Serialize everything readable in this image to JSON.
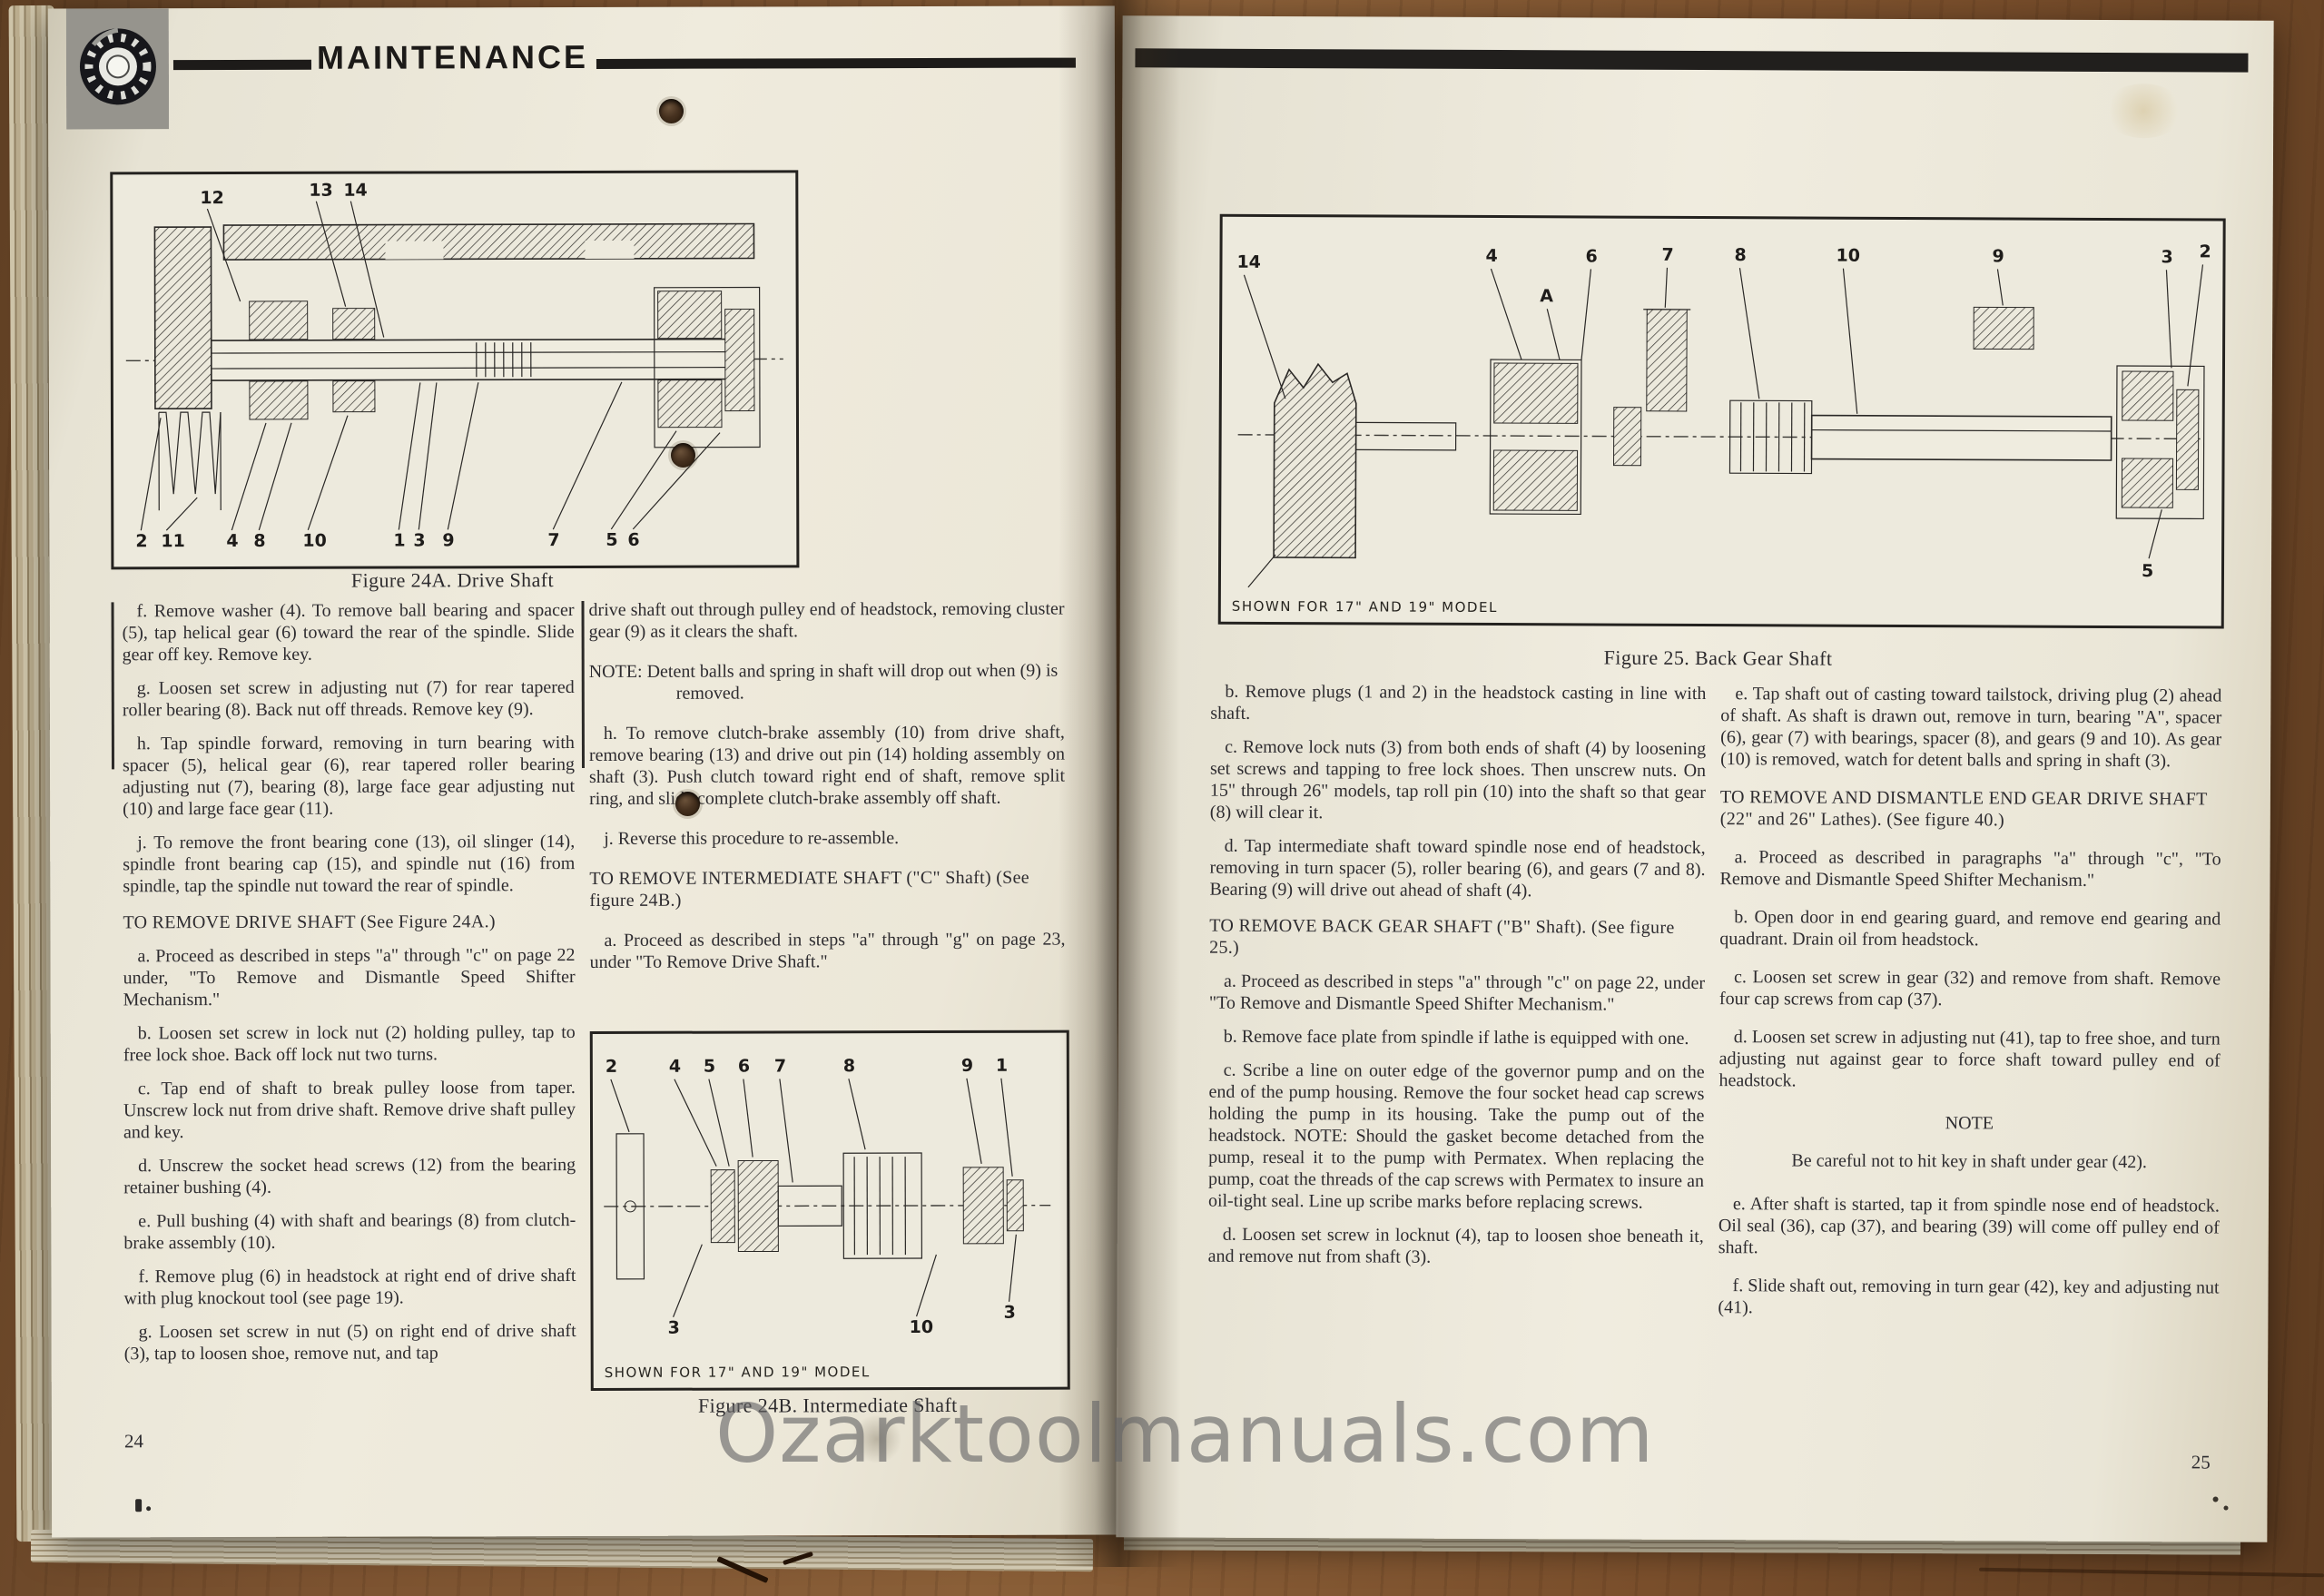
{
  "watermark": "Ozarktoolmanuals.com",
  "header": {
    "title": "MAINTENANCE"
  },
  "left_page": {
    "page_number": "24",
    "fig24a": {
      "caption": "Figure 24A.  Drive Shaft",
      "labels_top": [
        "12",
        "13",
        "14"
      ],
      "labels_bottom": [
        "2",
        "11",
        "4",
        "8",
        "10",
        "1",
        "3",
        "9",
        "7",
        "5",
        "6"
      ]
    },
    "fig24b": {
      "caption": "Figure 24B.  Intermediate Shaft",
      "note": "SHOWN FOR 17\" AND 19\" MODEL",
      "labels_top": [
        "2",
        "4",
        "5",
        "6",
        "7",
        "8",
        "9",
        "1"
      ],
      "labels_bottom": [
        "3",
        "10",
        "3"
      ]
    },
    "col1": [
      {
        "text": "f.  Remove washer (4).  To remove ball bearing and spacer (5), tap helical gear (6) toward the rear of the spindle.  Slide gear off key.  Remove key."
      },
      {
        "text": "g.  Loosen set screw in adjusting nut (7) for rear tapered roller bearing (8).  Back nut off threads.  Remove key (9)."
      },
      {
        "text": "h.  Tap spindle forward, removing in turn bearing with spacer (5), helical gear (6), rear tapered roller bearing adjusting nut (7), bearing (8), large face gear adjusting nut (10) and large face gear (11)."
      },
      {
        "text": "j.  To remove the front bearing cone (13), oil slinger (14), spindle front bearing cap (15), and spindle nut (16) from spindle, tap the spindle nut toward the rear of spindle."
      },
      {
        "text": "TO REMOVE DRIVE SHAFT (See Figure 24A.)"
      },
      {
        "text": "a.  Proceed as described in steps \"a\" through \"c\" on page 22 under, \"To Remove and Dismantle Speed Shifter Mechanism.\""
      },
      {
        "text": "b.  Loosen set screw in lock nut (2) holding pulley, tap to free lock shoe.  Back off lock nut two turns."
      },
      {
        "text": "c.  Tap end of shaft to break pulley loose from taper. Unscrew lock nut from drive shaft.  Remove drive shaft pulley and key."
      },
      {
        "text": "d.  Unscrew the socket head screws (12) from the bearing retainer bushing (4)."
      },
      {
        "text": "e.  Pull bushing (4) with shaft and bearings (8) from clutch-brake assembly (10)."
      },
      {
        "text": "f.  Remove plug (6) in headstock at right end of drive shaft with plug knockout tool (see page 19)."
      },
      {
        "text": "g.  Loosen set screw in nut (5) on right end of drive shaft (3), tap to loosen shoe, remove nut, and tap"
      }
    ],
    "col2": [
      {
        "text": "drive shaft out through pulley end of headstock, removing cluster gear (9) as it clears the shaft."
      },
      {
        "text": "NOTE:   Detent balls and spring in shaft will drop out when (9) is removed."
      },
      {
        "text": "h.  To remove clutch-brake assembly (10) from drive shaft, remove bearing (13) and drive out pin (14) holding assembly on shaft (3).  Push clutch toward right end of shaft, remove split ring, and slide complete clutch-brake assembly off shaft."
      },
      {
        "text": "j.  Reverse this procedure to re-assemble."
      },
      {
        "text": "TO REMOVE INTERMEDIATE SHAFT (\"C\" Shaft) (See figure 24B.)"
      },
      {
        "text": "a.  Proceed as described in steps \"a\" through \"g\" on page 23, under \"To Remove Drive Shaft.\""
      }
    ]
  },
  "right_page": {
    "page_number": "25",
    "fig25": {
      "caption": "Figure 25.  Back Gear Shaft",
      "note": "SHOWN FOR 17\" AND 19\" MODEL",
      "labels_top": [
        "14",
        "4",
        "A",
        "6",
        "7",
        "8",
        "10",
        "9",
        "3",
        "2"
      ],
      "labels_bottom": [
        "5"
      ]
    },
    "col1": [
      {
        "text": "b.  Remove plugs (1 and 2) in the headstock casting in line with shaft."
      },
      {
        "text": "c.  Remove lock nuts (3) from both ends of shaft (4) by loosening set screws and tapping to free lock shoes.  Then unscrew nuts.  On 15\" through 26\" models, tap roll pin (10) into the shaft so that gear (8) will clear it."
      },
      {
        "text": "d.  Tap intermediate shaft toward spindle nose end of headstock, removing in turn spacer (5), roller bearing (6), and gears (7 and 8).  Bearing (9) will drive out ahead of shaft (4)."
      },
      {
        "text": "TO REMOVE BACK GEAR SHAFT (\"B\" Shaft). (See figure 25.)"
      },
      {
        "text": "a.  Proceed as described in steps \"a\" through \"c\" on page 22, under \"To Remove and Dismantle Speed Shifter Mechanism.\""
      },
      {
        "text": "b.  Remove face plate from spindle if lathe is equipped with one."
      },
      {
        "text": "c.  Scribe a line on outer edge of the governor pump and on the end of the pump housing.  Remove the four socket head cap screws holding the pump in its housing.  Take the pump out of the headstock.  NOTE: Should the gasket become detached from the pump, reseal it to the pump with Permatex.  When replacing the pump, coat the threads of the cap screws with Permatex to insure an oil-tight seal.  Line up scribe marks before replacing screws."
      },
      {
        "text": "d.  Loosen set screw in locknut (4), tap to loosen shoe beneath it, and remove nut from shaft (3)."
      }
    ],
    "col2": [
      {
        "text": "e.  Tap shaft out of casting toward tailstock, driving plug (2) ahead of shaft.  As shaft is drawn out, remove in turn, bearing \"A\", spacer (6), gear (7) with bearings, spacer (8), and gears (9 and 10).  As gear (10) is removed, watch for detent balls and spring in shaft (3)."
      },
      {
        "text": "TO REMOVE AND DISMANTLE END GEAR DRIVE SHAFT (22\" and 26\" Lathes).  (See figure 40.)"
      },
      {
        "text": "a.  Proceed as described in paragraphs \"a\" through \"c\", \"To Remove and Dismantle Speed Shifter Mechanism.\""
      },
      {
        "text": "b.  Open door in end gearing guard, and remove end gearing and quadrant.  Drain oil from headstock."
      },
      {
        "text": "c.  Loosen set screw in gear (32) and remove from shaft.  Remove four cap screws from cap (37)."
      },
      {
        "text": "d.  Loosen set screw in adjusting nut (41), tap to free shoe, and turn adjusting nut against gear to force shaft toward pulley end of headstock."
      },
      {
        "text": "NOTE"
      },
      {
        "text": "Be careful not to hit key in shaft under gear (42)."
      },
      {
        "text": "e.  After shaft is started, tap it from spindle nose end of headstock.  Oil seal (36), cap (37), and bearing (39) will come off pulley end of shaft."
      },
      {
        "text": "f.  Slide shaft out, removing in turn gear (42), key and adjusting nut (41)."
      }
    ]
  }
}
